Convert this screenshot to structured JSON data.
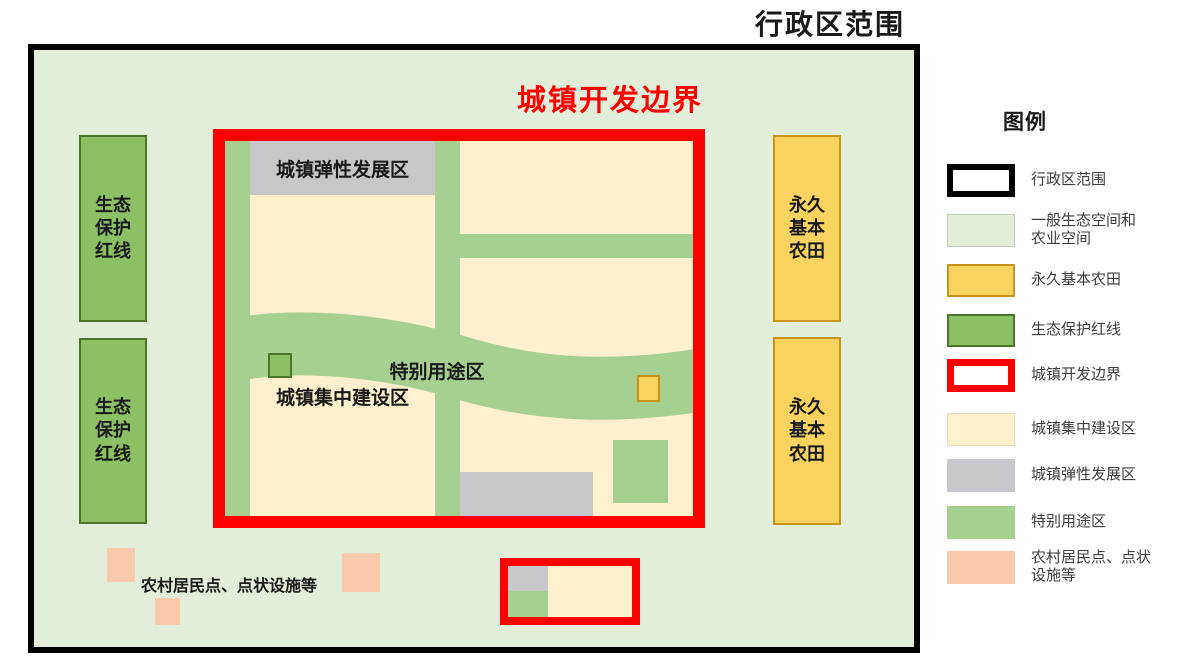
{
  "titles": {
    "admin_region": "行政区范围",
    "dev_boundary": "城镇开发边界"
  },
  "map": {
    "eco_rects": [
      {
        "label": "生态\n保护\n红线"
      },
      {
        "label": "生态\n保护\n红线"
      }
    ],
    "farm_rects": [
      {
        "label": "永久\n基本\n农田"
      },
      {
        "label": "永久\n基本\n农田"
      }
    ],
    "flex_zone_label": "城镇弹性发展区",
    "build_zone_label": "城镇集中建设区",
    "special_zone_label": "特别用途区",
    "rural_label": "农村居民点、点状设施等"
  },
  "legend": {
    "title": "图例",
    "items": [
      {
        "label": "行政区范围",
        "swatch": "admin"
      },
      {
        "label": "一般生态空间和\n农业空间",
        "swatch": "general"
      },
      {
        "label": "永久基本农田",
        "swatch": "farm"
      },
      {
        "label": "生态保护红线",
        "swatch": "eco"
      },
      {
        "label": "城镇开发边界",
        "swatch": "boundary"
      },
      {
        "label": "城镇集中建设区",
        "swatch": "build"
      },
      {
        "label": "城镇弹性发展区",
        "swatch": "flex"
      },
      {
        "label": "特别用途区",
        "swatch": "special"
      },
      {
        "label": "农村居民点、点状\n设施等",
        "swatch": "rural"
      }
    ]
  },
  "colors": {
    "admin_fill": "#e2eed9",
    "admin_border": "#000000",
    "eco_fill": "#8dbf63",
    "eco_border": "#4d752a",
    "farm_fill": "#fad35f",
    "farm_border": "#c8941c",
    "boundary_red": "#fe0000",
    "build_fill": "#fdf0cd",
    "flex_fill": "#c7c6cb",
    "special_fill": "#a7cf90",
    "rural_fill": "#f7cbac"
  }
}
